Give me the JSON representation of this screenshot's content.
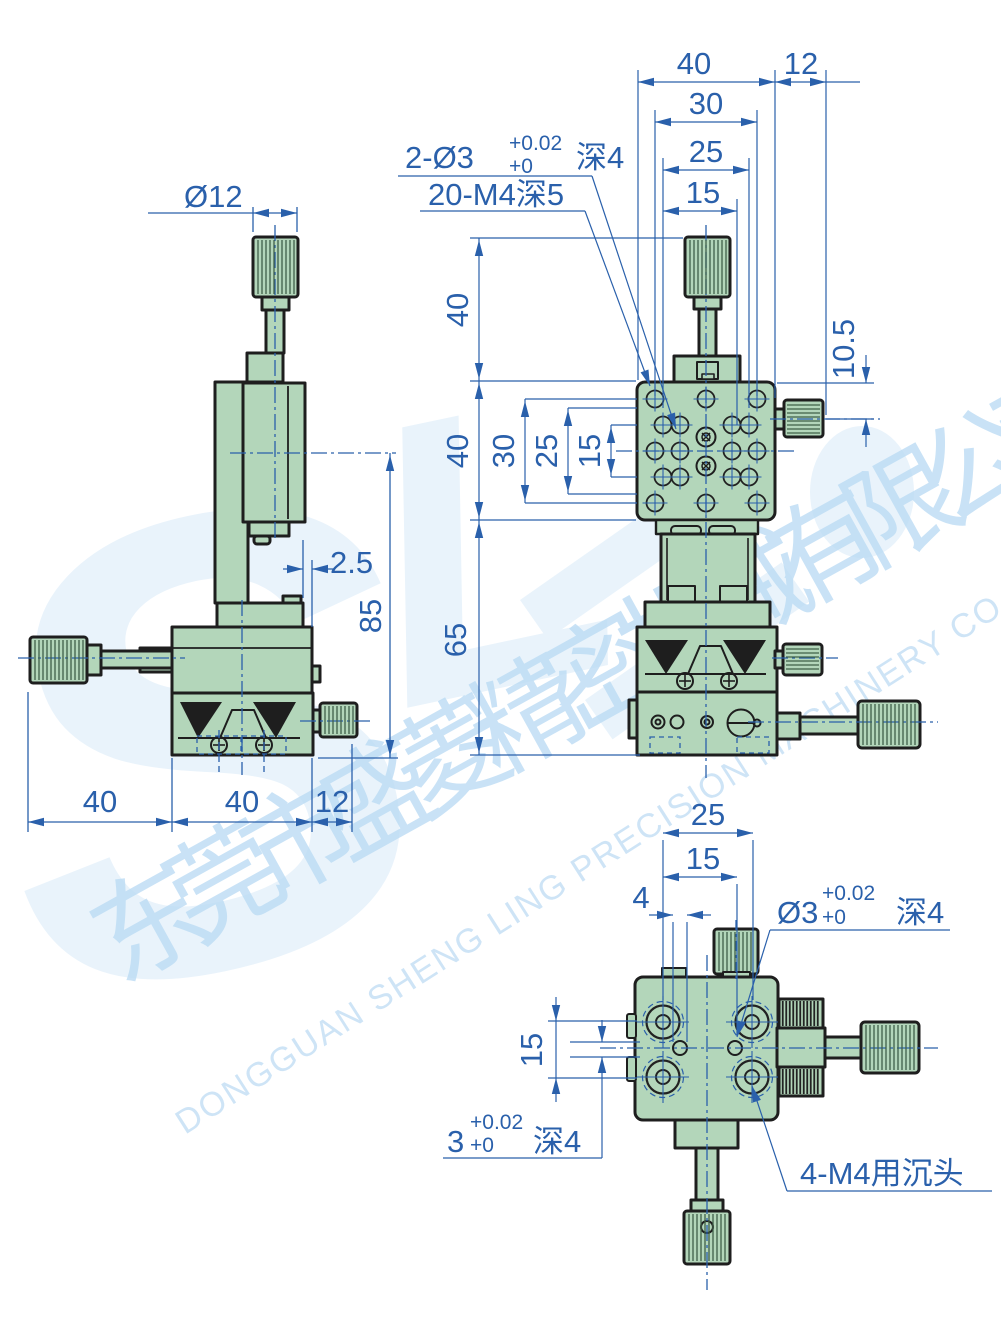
{
  "watermark": {
    "logo_hint_1": "S",
    "logo_hint_2": "L",
    "company_cn": "东莞市盛菱精密机械有限公司",
    "company_en": "DONGGUAN SHENG LING PRECISION MACHINERY CO., LTD."
  },
  "colors": {
    "dimension_blue": "#2a60ab",
    "part_fill_green": "#b3d6ba",
    "outline_dark": "#1e1e1e",
    "watermark_blue": "#bcdcf4"
  },
  "side_view": {
    "dia_knob": "Ø12",
    "offset": "2.5",
    "height": "85",
    "w_left": "40",
    "w_mid": "40",
    "w_right": "12"
  },
  "front_view": {
    "top_w": "40",
    "top_r": "12",
    "w30": "30",
    "w25": "25",
    "w15": "15",
    "h_top": "40",
    "h_plate": "40",
    "h_base": "65",
    "r30": "30",
    "r25": "25",
    "r15": "15",
    "knob_off": "10.5",
    "pin_label": {
      "pre": "2-Ø3",
      "tu": "+0.02",
      "td": "+0",
      "depth": "深4"
    },
    "m4_label": "20-M4深5"
  },
  "bottom_view": {
    "w25": "25",
    "w15": "15",
    "w4": "4",
    "h15": "15",
    "pin_label": {
      "pre": "Ø3",
      "tu": "+0.02",
      "td": "+0",
      "depth": "深4"
    },
    "slot_label": {
      "pre": "3",
      "tu": "+0.02",
      "td": "+0",
      "depth": "深4"
    },
    "cbore_label": "4-M4用沉头"
  }
}
